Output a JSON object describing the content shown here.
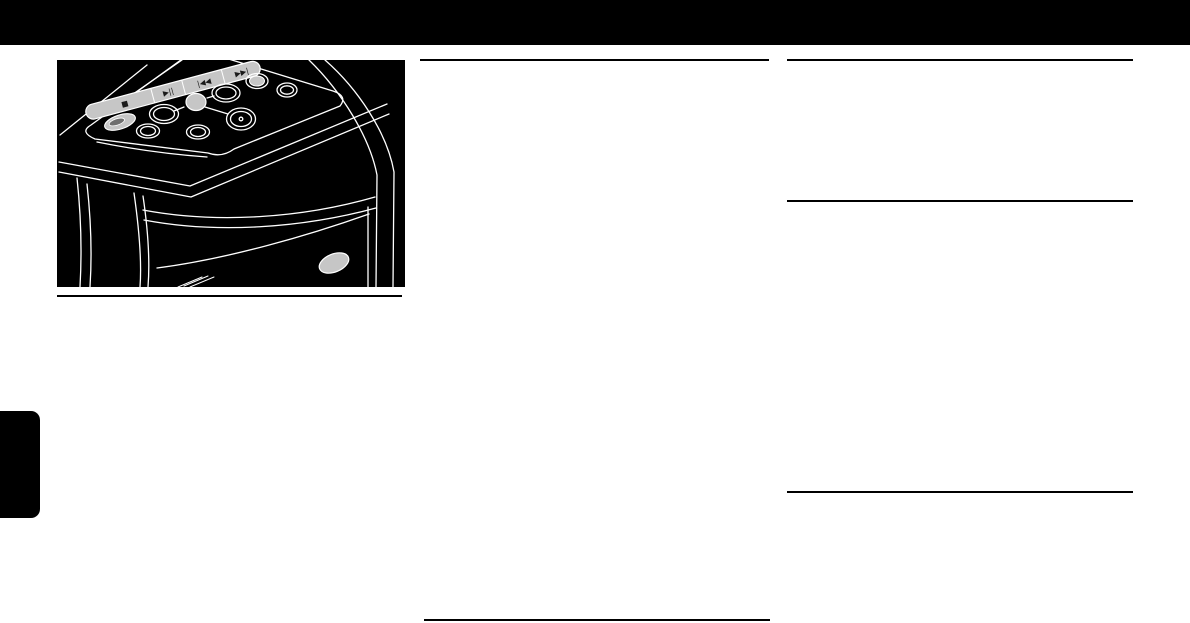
{
  "page": {
    "kind": "user-manual-page",
    "background_color": "#ffffff",
    "header_bar_color": "#000000",
    "rule_color": "#000000",
    "section_tab_color": "#000000"
  },
  "figure": {
    "subject": "mini-hifi-system-top-panel-illustration",
    "background_color": "#000000",
    "line_color": "#ffffff",
    "button_fill_color": "#c6c6c6",
    "button_hole_color": "#6f6f6f",
    "symbol_color": "#1a1a1a",
    "transport_buttons": [
      {
        "name": "stop",
        "symbol": "■"
      },
      {
        "name": "play-pause",
        "symbol": "▶||"
      },
      {
        "name": "previous",
        "symbol": "|◀◀"
      },
      {
        "name": "next",
        "symbol": "▶▶|"
      }
    ]
  }
}
